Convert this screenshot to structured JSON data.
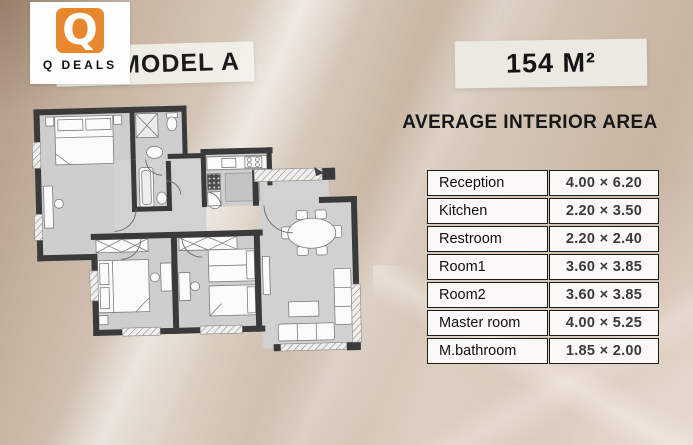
{
  "logo": {
    "brand": "Q DEALS",
    "monogram": "Q"
  },
  "banners": {
    "model": "MODEL A",
    "area": "154 M²"
  },
  "table": {
    "title": "AVERAGE INTERIOR AREA",
    "rows": [
      {
        "room": "Reception",
        "size": "4.00 × 6.20"
      },
      {
        "room": "Kitchen",
        "size": "2.20 × 3.50"
      },
      {
        "room": "Restroom",
        "size": "2.20 × 2.40"
      },
      {
        "room": "Room1",
        "size": "3.60 × 3.85"
      },
      {
        "room": "Room2",
        "size": "3.60 × 3.85"
      },
      {
        "room": "Master room",
        "size": "4.00 × 5.25"
      },
      {
        "room": "M.bathroom",
        "size": "1.85 × 2.00"
      }
    ]
  },
  "colors": {
    "brand_orange": "#e8872b",
    "background_beige": "#c9b7a6",
    "wall_dark": "#3a3a3a",
    "floor_gray": "#cecece",
    "table_cell_bg": "#fbf9f5",
    "table_border": "#1d1d1d",
    "text_dark": "#151515"
  }
}
